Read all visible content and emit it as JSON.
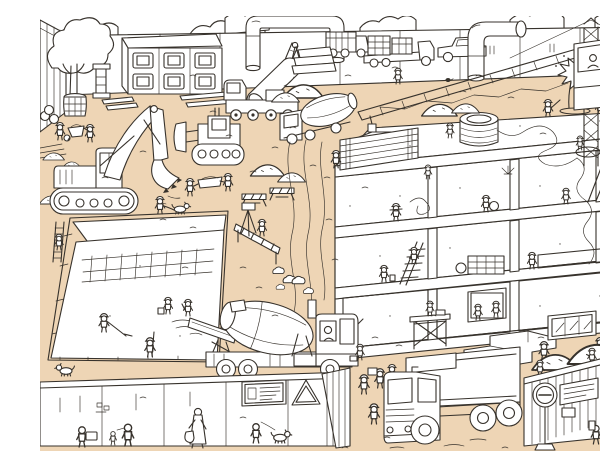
{
  "scene": {
    "title": "Busy construction site — black-and-white coloring-book line illustration on sand-colored ground",
    "style": "line art, no text, sand/tan ground wash",
    "palette": {
      "ink": "#37322c",
      "paper": "#ffffff",
      "sand": "#eed5b5"
    },
    "areas": {
      "top_left": "perimeter hoarding and hedge, tree in barrel planter, site-office container with six windows, workers with wheelbarrow, stacked pipes and planks",
      "top_center": "overhead pipe bridge, mobile crane lifting a concrete pipe, dump truck, flatbed truck loaded with crates, concrete mixer truck, stacked concrete blocks, sand piles",
      "top_right": "pickup truck, large duct pipe, tower crane with operator cabin, lattice jib, burst water pipe geyser with workers",
      "middle_left": "tracked excavator digging, bulldozer, two workers carrying a hod, worker walking a dog, rocks and sand piles",
      "middle_right": "three-storey concrete frame building under construction, cable spool on roof, electrician pulling a long cable, masons laying bricks, ladder, scaffold, window installers, precast stairs",
      "bottom_left": "foundation pit with fresh concrete, rebar mat, workers raking and screeding, worker on ladder, dog",
      "bottom_center": "concrete mixer truck pouring into the pit, exhaust puffs, site hoarding with notice board and warning triangle, man walking a dog, pedestrians on sidewalk",
      "bottom_right": "heavy dump truck, corrugated hoarding with round sign and notice board, sand piles, pedestrian with backpack"
    }
  }
}
